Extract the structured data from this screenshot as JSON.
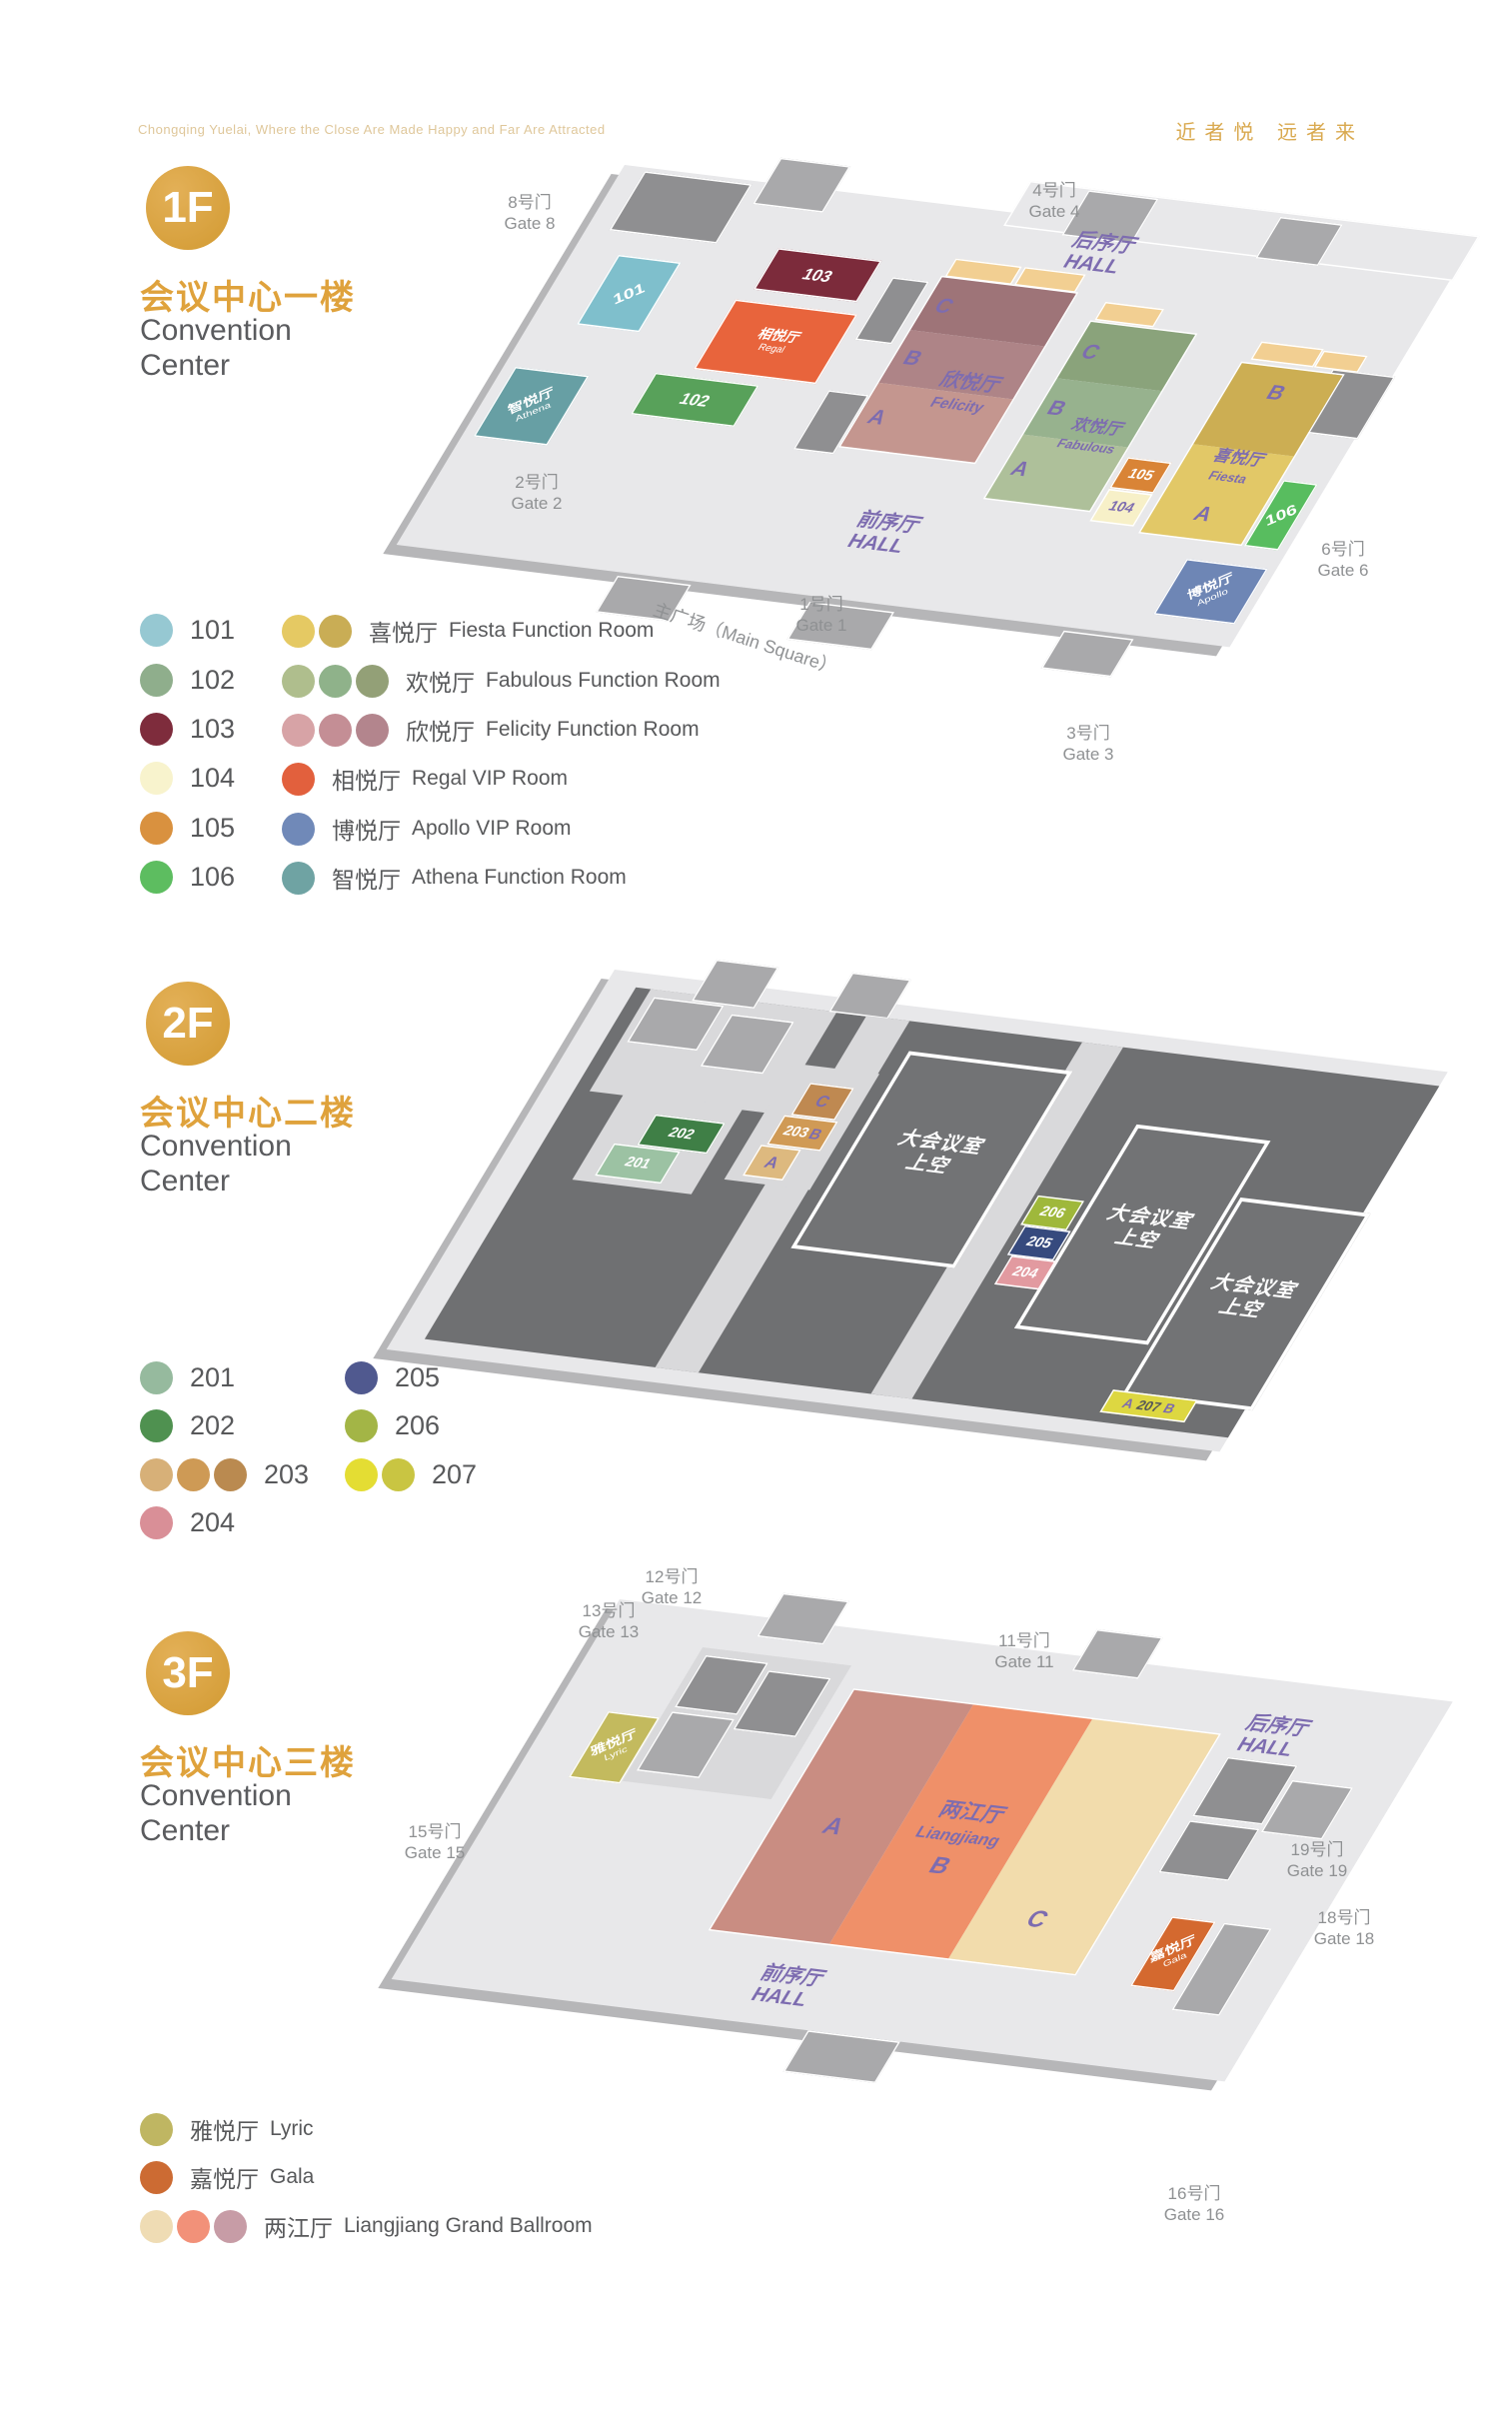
{
  "page": {
    "tagline": "Chongqing Yuelai, Where the Close Are Made Happy and Far Are Attracted",
    "slogan": "近者悦  远者来"
  },
  "letters": {
    "a": "A",
    "b": "B",
    "c": "C"
  },
  "floors": [
    {
      "badge": "1F",
      "title_zh": "会议中心一楼",
      "title_en": "Convention\nCenter",
      "legend_left": [
        {
          "num": "101",
          "cs": [
            "#96c8d2"
          ]
        },
        {
          "num": "102",
          "cs": [
            "#8fae8c"
          ]
        },
        {
          "num": "103",
          "cs": [
            "#7e2c3c"
          ]
        },
        {
          "num": "104",
          "cs": [
            "#f8f3cd"
          ]
        },
        {
          "num": "105",
          "cs": [
            "#d9913f"
          ]
        },
        {
          "num": "106",
          "cs": [
            "#5dbd60"
          ]
        }
      ],
      "legend_right": [
        {
          "zh": "喜悦厅",
          "en": "Fiesta Function Room",
          "cs": [
            "#e5c963",
            "#c9ad55"
          ]
        },
        {
          "zh": "欢悦厅",
          "en": "Fabulous Function Room",
          "cs": [
            "#afbe8d",
            "#8fb28a",
            "#93a077"
          ]
        },
        {
          "zh": "欣悦厅",
          "en": "Felicity Function Room",
          "cs": [
            "#d7a3a6",
            "#c48e95",
            "#b3858d"
          ]
        },
        {
          "zh": "相悦厅",
          "en": "Regal VIP Room",
          "cs": [
            "#e2603d"
          ]
        },
        {
          "zh": "博悦厅",
          "en": "Apollo VIP Room",
          "cs": [
            "#7089b8"
          ]
        },
        {
          "zh": "智悦厅",
          "en": "Athena Function Room",
          "cs": [
            "#6fa3a3"
          ]
        }
      ],
      "halls": {
        "rear": "后序厅\nHALL",
        "front": "前序厅\nHALL"
      },
      "main_square": "主广场（Main Square）",
      "gates": [
        {
          "t": "8号门\nGate 8"
        },
        {
          "t": "4号门\nGate 4"
        },
        {
          "t": "2号门\nGate 2"
        },
        {
          "t": "1号门\nGate 1"
        },
        {
          "t": "3号门\nGate 3"
        },
        {
          "t": "6号门\nGate 6"
        }
      ],
      "rooms": {
        "r101": {
          "t": "101",
          "c": "#7fbfcc"
        },
        "r102": {
          "t": "102",
          "c": "#58a15a"
        },
        "r103": {
          "t": "103",
          "c": "#7c2b3b"
        },
        "r104": {
          "t": "104",
          "c": "#f7f0c8"
        },
        "r105": {
          "t": "105",
          "c": "#d98436"
        },
        "r106": {
          "t": "106",
          "c": "#58bd5f"
        },
        "regal": {
          "zh": "相悦厅",
          "en": "Regal",
          "c": "#e8643c"
        },
        "athena": {
          "zh": "智悦厅",
          "en": "Athena",
          "c": "#679fa4"
        },
        "apollo": {
          "zh": "博悦厅",
          "en": "Apollo",
          "c": "#6e86b5"
        },
        "felicity": {
          "zh": "欣悦厅",
          "en": "Felicity",
          "ca": "#c4968f",
          "cb": "#ae8487",
          "cc": "#9e7478"
        },
        "fabulous": {
          "zh": "欢悦厅",
          "en": "Fabulous",
          "ca": "#aec09a",
          "cb": "#97b28e",
          "cc": "#8aa37b"
        },
        "fiesta": {
          "zh": "喜悦厅",
          "en": "Fiesta",
          "ca": "#e2c867",
          "cb": "#ccae53"
        }
      }
    },
    {
      "badge": "2F",
      "title_zh": "会议中心二楼",
      "title_en": "Convention\nCenter",
      "legend_left": [
        {
          "num": "201",
          "cs": [
            "#96ba9e"
          ]
        },
        {
          "num": "202",
          "cs": [
            "#4f9150"
          ]
        },
        {
          "num": "203",
          "cs": [
            "#d7b078",
            "#ce9a55",
            "#ba8a50"
          ]
        },
        {
          "num": "204",
          "cs": [
            "#d98f97"
          ]
        }
      ],
      "legend_right": [
        {
          "num": "205",
          "cs": [
            "#50598f"
          ]
        },
        {
          "num": "206",
          "cs": [
            "#a3b546"
          ]
        },
        {
          "num": "207",
          "cs": [
            "#e4dd33",
            "#c9c542"
          ]
        }
      ],
      "overhead": "大会议室\n上空",
      "rooms": {
        "r201": {
          "t": "201",
          "c": "#9cc2a3"
        },
        "r202": {
          "t": "202",
          "c": "#3f7f46"
        },
        "r203": {
          "t": "203",
          "ctop": "#bf8951",
          "cmid": "#d09a55",
          "ca": "#ddb97f"
        },
        "r204": {
          "t": "204",
          "c": "#e29aa0"
        },
        "r205": {
          "t": "205",
          "c": "#364a7e"
        },
        "r206": {
          "t": "206",
          "c": "#9fb83b"
        },
        "r207": {
          "t": "207",
          "c": "#ddd741"
        }
      }
    },
    {
      "badge": "3F",
      "title_zh": "会议中心三楼",
      "title_en": "Convention\nCenter",
      "legend_rows": [
        {
          "zh": "雅悦厅",
          "en": "Lyric",
          "cs": [
            "#bfb662"
          ]
        },
        {
          "zh": "嘉悦厅",
          "en": "Gala",
          "cs": [
            "#cc6b33"
          ]
        },
        {
          "zh": "两江厅",
          "en": "Liangjiang Grand Ballroom",
          "cs": [
            "#efdcb4",
            "#f29179",
            "#c79ca6"
          ]
        }
      ],
      "halls": {
        "rear": "后序厅\nHALL",
        "front": "前序厅\nHALL"
      },
      "gates": [
        {
          "t": "12号门\nGate 12"
        },
        {
          "t": "13号门\nGate 13"
        },
        {
          "t": "11号门\nGate 11"
        },
        {
          "t": "15号门\nGate 15"
        },
        {
          "t": "19号门\nGate 19"
        },
        {
          "t": "18号门\nGate 18"
        },
        {
          "t": "16号门\nGate 16"
        }
      ],
      "rooms": {
        "lyric": {
          "zh": "雅悦厅",
          "en": "Lyric",
          "c": "#c3ba5e"
        },
        "gala": {
          "zh": "嘉悦厅",
          "en": "Gala",
          "c": "#d4692f"
        },
        "liangjiang": {
          "zh": "两江厅",
          "en": "Liangjiang",
          "ca": "#c98d82",
          "cb": "#ef9069",
          "cc": "#f2dcac"
        }
      }
    }
  ]
}
